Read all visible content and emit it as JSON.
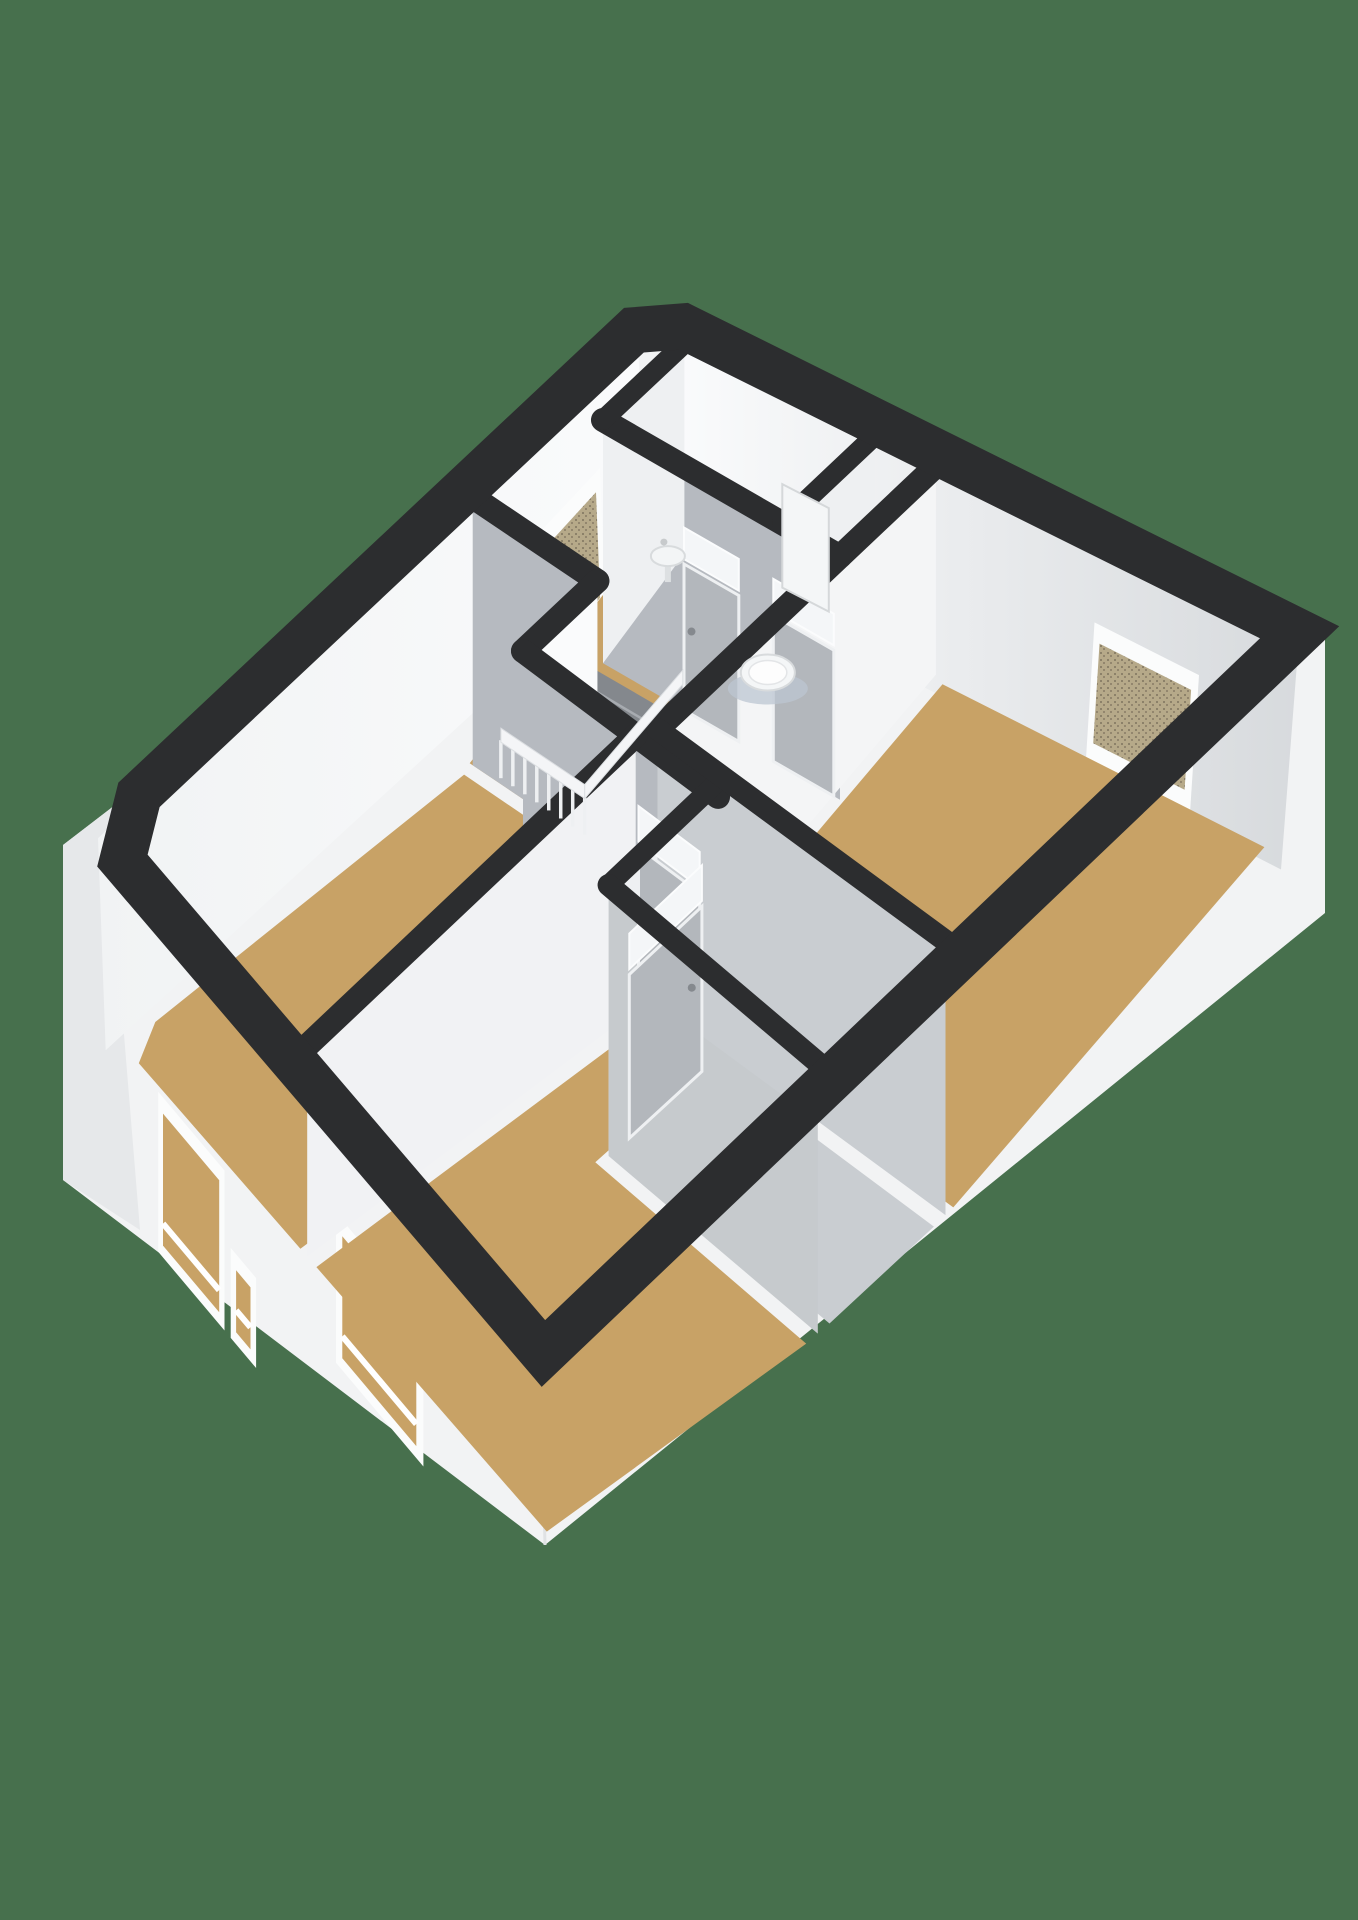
{
  "page": {
    "kind": "3d-floorplan-render",
    "background_color": "#47704d"
  },
  "colors": {
    "background": "#47704d",
    "wall_top": "#2c2d2f",
    "exterior_face": "#f2f3f4",
    "exterior_face_shaded": "#e6e8ea",
    "interior_white": "#f4f5f6",
    "interior_gray": "#b6bac0",
    "floor_wood": "#c8a266",
    "floor_bathroom": "#ccd4dd",
    "floor_closet": "#c9cdd1",
    "stair_opening": "#84888d",
    "window_glass_speckled": "#b6a989",
    "window_frame": "#fbfcfc",
    "door_leaf": "#b3b7bc",
    "fixture_white": "#f4f6f7"
  },
  "scene": {
    "projection": {
      "a": 301.4,
      "b": -570.8,
      "c": 655,
      "d": 153.3,
      "e": 527.5,
      "f": 300,
      "g": -0.2782,
      "h": -0.009,
      "drop_base": 200,
      "drop_bow": 300
    },
    "silhouette": {
      "band_width": 46,
      "ring": [
        [
          0.075,
          0.015
        ],
        [
          0.985,
          0.015
        ],
        [
          0.985,
          0.985
        ],
        [
          0.085,
          0.985
        ],
        [
          0.015,
          0.915
        ],
        [
          0.015,
          0.05
        ]
      ],
      "outline": [
        [
          0.075,
          0
        ],
        [
          1,
          0
        ]
      ],
      "east_bottom": [
        1325,
        913
      ],
      "south_bottom": [
        545,
        1545
      ],
      "west_bottom_low": [
        63,
        1180
      ],
      "west_bottom_high": [
        63,
        845
      ],
      "west_bevel_t": 0.93,
      "north_bevel_t": 0.045
    },
    "rooms": [
      {
        "name": "room-bathroom",
        "color": "#ccd4dd",
        "pts": [
          [
            0.1,
            0.035
          ],
          [
            0.425,
            0.035
          ],
          [
            0.425,
            0.168
          ],
          [
            0.1,
            0.168
          ]
        ]
      },
      {
        "name": "room-hall-nook",
        "color": "#c8a266",
        "pts": [
          [
            0.445,
            0.035
          ],
          [
            0.515,
            0.035
          ],
          [
            0.515,
            0.168
          ],
          [
            0.445,
            0.168
          ]
        ]
      },
      {
        "name": "room-bedroom-right",
        "color": "#c8a266",
        "pts": [
          [
            0.545,
            0.035
          ],
          [
            0.963,
            0.035
          ],
          [
            0.963,
            0.44
          ],
          [
            0.545,
            0.44
          ]
        ]
      },
      {
        "name": "room-landing",
        "color": "#c8a266",
        "pts": [
          [
            0.03,
            0.035
          ],
          [
            0.1,
            0.035
          ],
          [
            0.1,
            0.168
          ],
          [
            0.515,
            0.168
          ],
          [
            0.515,
            0.47
          ],
          [
            0.3,
            0.47
          ],
          [
            0.3,
            0.35
          ],
          [
            0.03,
            0.35
          ]
        ]
      },
      {
        "name": "room-bedroom-left",
        "color": "#c8a266",
        "pts": [
          [
            0.037,
            0.365
          ],
          [
            0.285,
            0.365
          ],
          [
            0.285,
            0.485
          ],
          [
            0.5,
            0.485
          ],
          [
            0.5,
            0.963
          ],
          [
            0.095,
            0.963
          ],
          [
            0.037,
            0.9
          ]
        ]
      },
      {
        "name": "room-bedroom-bottom",
        "color": "#c8a266",
        "pts": [
          [
            0.535,
            0.485
          ],
          [
            0.635,
            0.485
          ],
          [
            0.635,
            0.63
          ],
          [
            0.963,
            0.63
          ],
          [
            0.963,
            0.963
          ],
          [
            0.535,
            0.963
          ]
        ]
      },
      {
        "name": "room-closet",
        "color": "#c9cdd1",
        "pts": [
          [
            0.655,
            0.465
          ],
          [
            0.963,
            0.465
          ],
          [
            0.963,
            0.6
          ],
          [
            0.655,
            0.6
          ]
        ]
      }
    ],
    "walls": [
      {
        "name": "wall-bathroom-south",
        "s1": 0.1,
        "t1": 0.175,
        "s2": 0.53,
        "t2": 0.175,
        "face": "#b6bac0",
        "w": 24
      },
      {
        "name": "wall-bathroom-west",
        "s1": 0.1,
        "t1": 0.035,
        "s2": 0.1,
        "t2": 0.175,
        "face": "#eef0f2",
        "w": 20
      },
      {
        "name": "wall-bathroom-partition",
        "s1": 0.435,
        "t1": 0.03,
        "s2": 0.435,
        "t2": 0.175,
        "face": "#eef0f2",
        "w": 20
      },
      {
        "name": "wall-bedroom-right-west",
        "s1": 0.53,
        "t1": 0.03,
        "s2": 0.53,
        "t2": 0.455,
        "face": "#f4f5f6",
        "w": 24
      },
      {
        "name": "wall-landing-north",
        "s1": 0.037,
        "t1": 0.35,
        "s2": 0.3,
        "t2": 0.35,
        "face": "#b6bac0",
        "w": 24
      },
      {
        "name": "wall-landing-arm-east",
        "s1": 0.3,
        "t1": 0.35,
        "s2": 0.3,
        "t2": 0.47,
        "face": "#fafbfc",
        "w": 24
      },
      {
        "name": "wall-bottomroom-north",
        "s1": 0.3,
        "t1": 0.47,
        "s2": 0.655,
        "t2": 0.47,
        "face": "#b6bac0",
        "w": 24
      },
      {
        "name": "wall-bedrooms-divider",
        "s1": 0.515,
        "t1": 0.47,
        "s2": 0.515,
        "t2": 0.963,
        "face": "#f1f2f4",
        "w": 24
      },
      {
        "name": "wall-closet-west",
        "s1": 0.64,
        "t1": 0.455,
        "s2": 0.64,
        "t2": 0.615,
        "face": "#eef0f2",
        "w": 20
      },
      {
        "name": "wall-closet-south",
        "s1": 0.64,
        "t1": 0.615,
        "s2": 0.963,
        "t2": 0.615,
        "face": "#c6cacd",
        "w": 22
      },
      {
        "name": "wall-bedroom-right-south",
        "s1": 0.53,
        "t1": 0.45,
        "s2": 0.963,
        "t2": 0.45,
        "face": "#c9cdd1",
        "w": 22
      }
    ],
    "doors": [
      {
        "name": "door-bathroom",
        "dir": "u",
        "fix": 0.175,
        "from": 0.26,
        "to": 0.36
      },
      {
        "name": "door-nook",
        "dir": "u",
        "fix": 0.175,
        "from": 0.42,
        "to": 0.52
      },
      {
        "name": "door-bedroom-bottom",
        "dir": "u",
        "fix": 0.47,
        "from": 0.52,
        "to": 0.625
      },
      {
        "name": "door-closet",
        "dir": "v",
        "fix": 0.64,
        "from": 0.48,
        "to": 0.585
      }
    ],
    "windows": [
      {
        "name": "window-landing-left",
        "wall": "nw",
        "from": 0.125,
        "to": 0.255,
        "k1": 0.4,
        "k2": 1.0,
        "glass": "speckle"
      },
      {
        "name": "window-nook-small",
        "wall": "ne",
        "from": 0.46,
        "to": 0.525,
        "k1": 0.24,
        "k2": 0.6,
        "glass": "plain"
      },
      {
        "name": "window-bedroom-right",
        "wall": "ne",
        "from": 0.755,
        "to": 0.885,
        "k1": 0.35,
        "k2": 0.95,
        "glass": "speckle"
      },
      {
        "name": "window-ext-left-wide",
        "wall": "sw",
        "from": 0.21,
        "to": 0.38,
        "dy1": 170,
        "dy2": 330
      },
      {
        "name": "window-ext-left-small",
        "wall": "sw",
        "from": 0.395,
        "to": 0.455,
        "dy1": 240,
        "dy2": 330
      },
      {
        "name": "window-ext-bottom",
        "wall": "sw",
        "from": 0.63,
        "to": 0.8,
        "dy1": 80,
        "dy2": 230
      }
    ],
    "stairs": {
      "name": "staircase",
      "opening": [
        [
          0.1,
          0.185
        ],
        [
          0.27,
          0.185
        ],
        [
          0.27,
          0.345
        ],
        [
          0.1,
          0.345
        ]
      ],
      "steps_t": [
        0.205,
        0.231,
        0.257,
        0.283,
        0.309,
        0.335
      ],
      "rail_t": 0.35,
      "rail_s_from": 0.1,
      "rail_s_to": 0.275,
      "spindle_count": 8
    },
    "fixtures": [
      {
        "name": "toilet-fixture",
        "s": 0.345,
        "t": 0.115,
        "cistern_t": 0.055,
        "cs1": 0.305,
        "cs2": 0.385
      },
      {
        "name": "sink-fixture",
        "s": 0.125,
        "t": 0.085
      }
    ]
  }
}
